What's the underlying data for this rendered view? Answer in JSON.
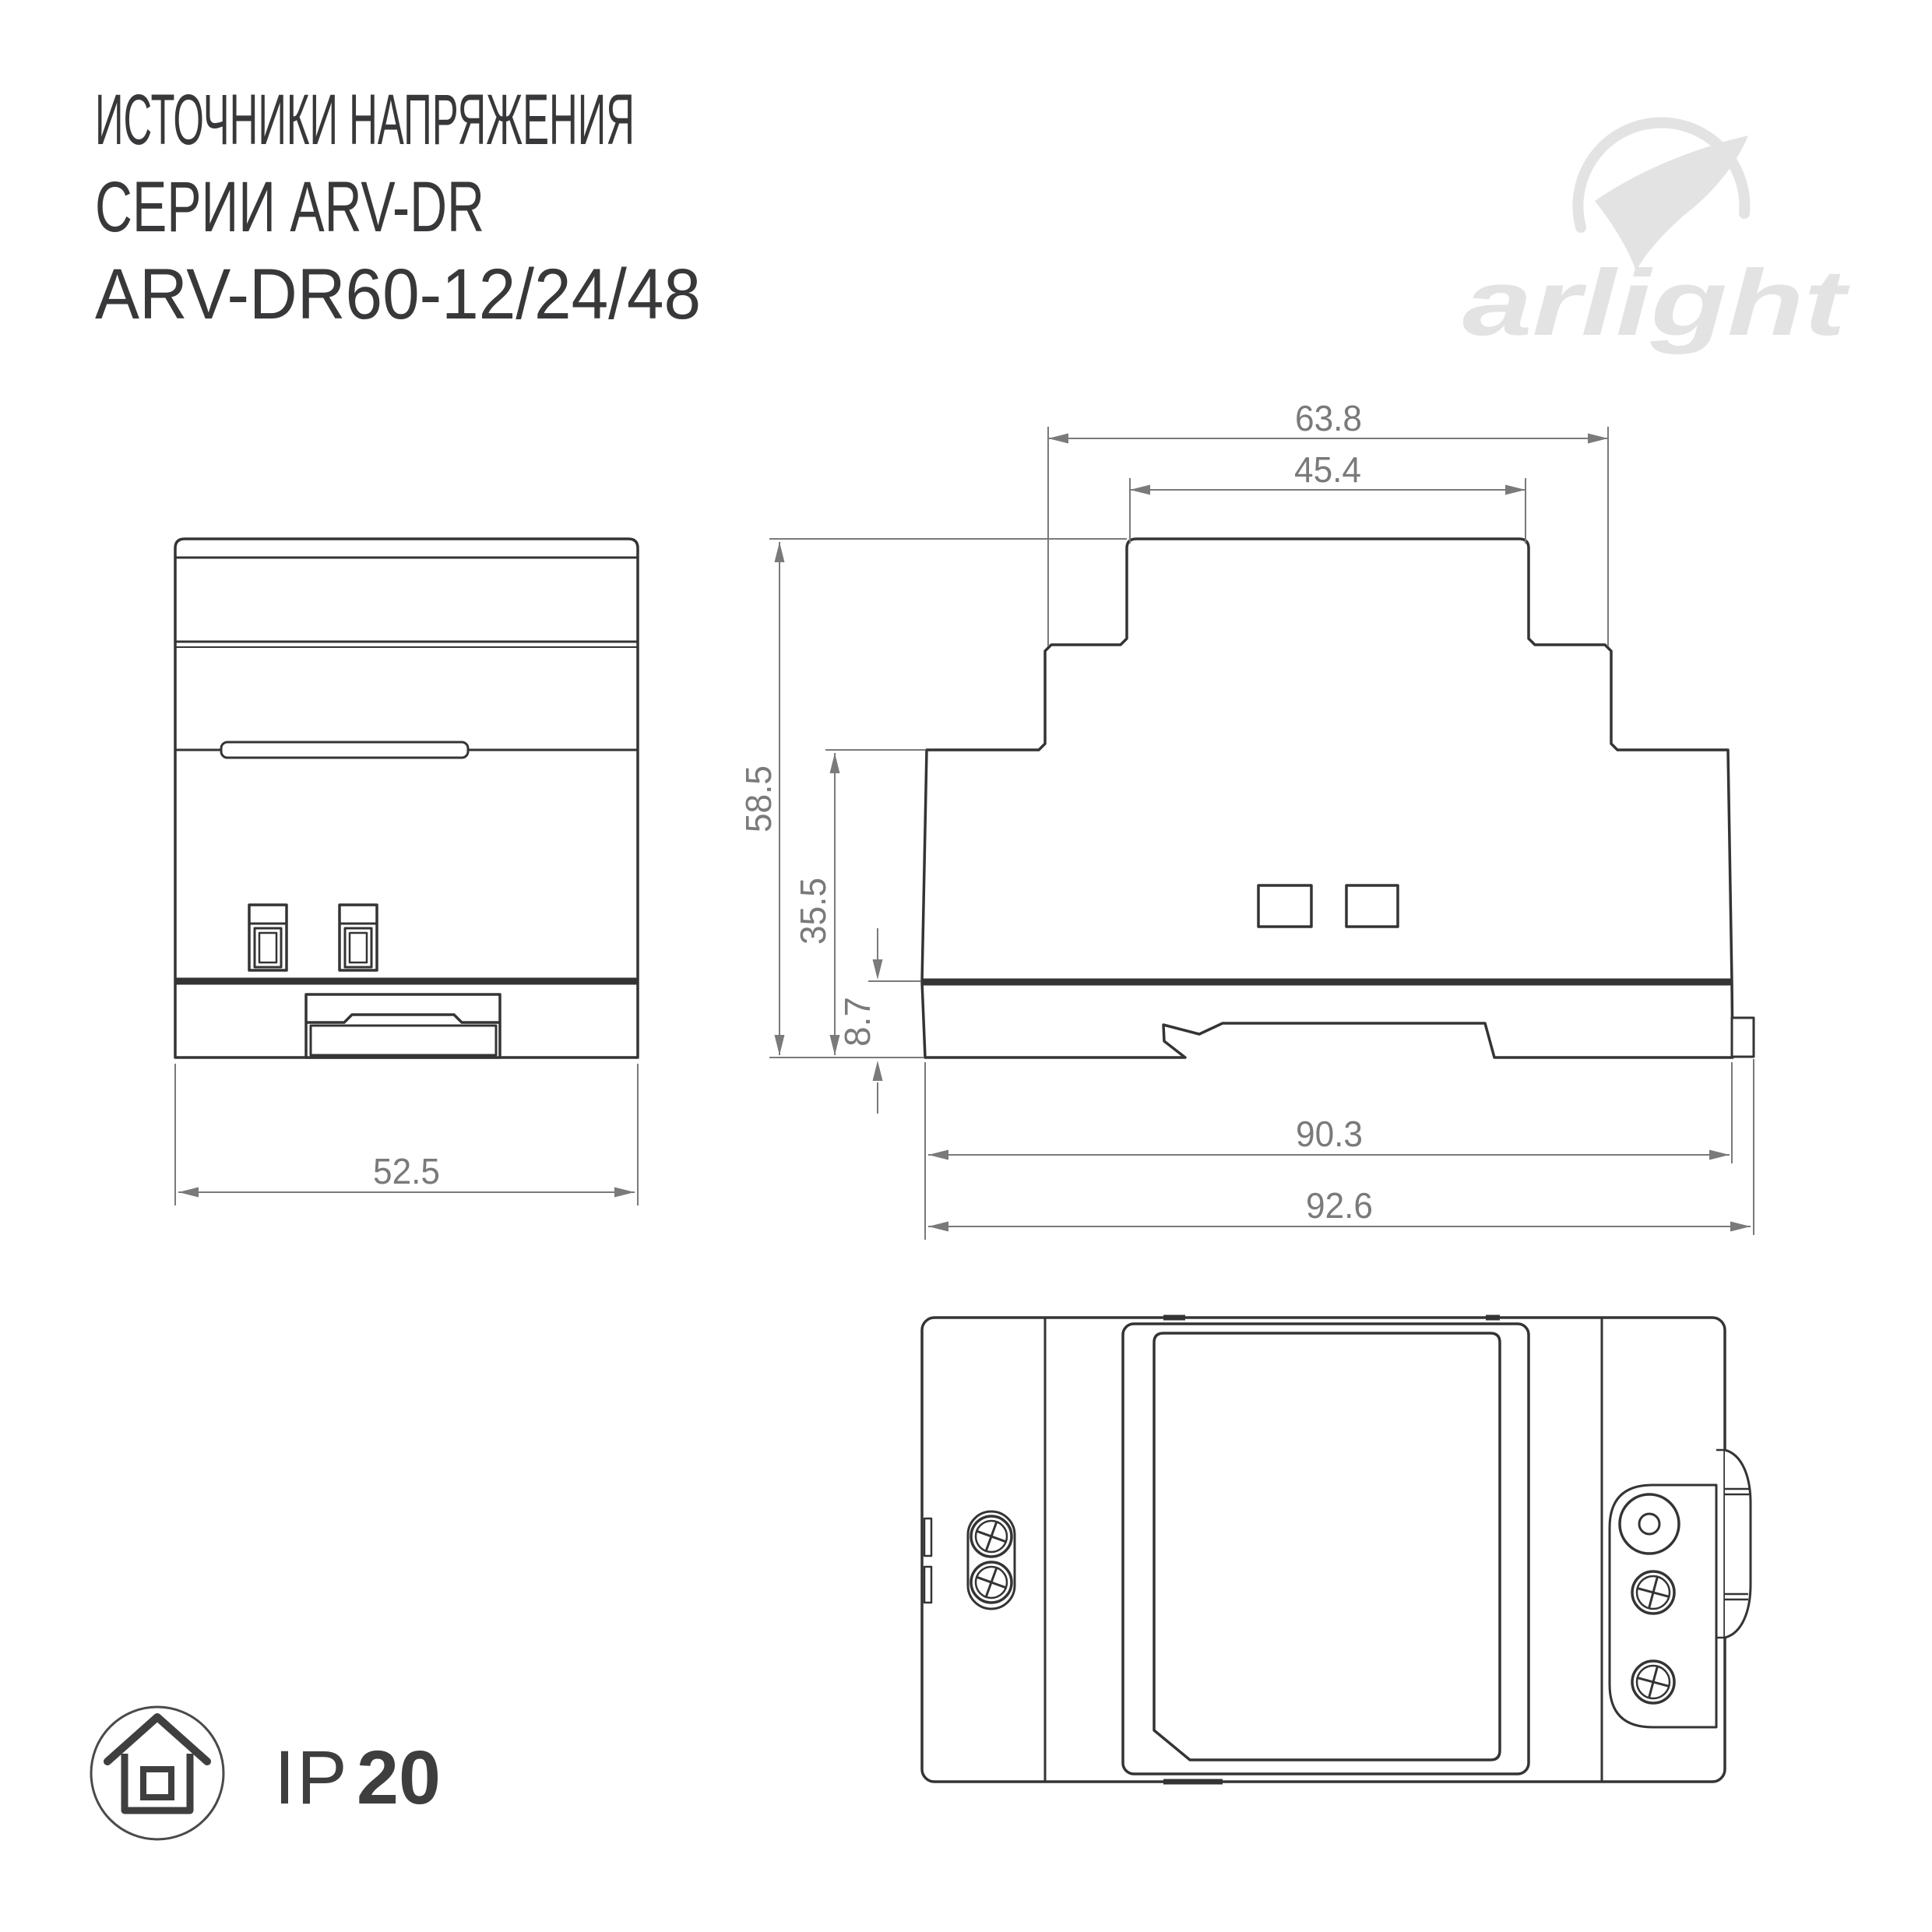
{
  "title": {
    "line1": "ИСТОЧНИКИ НАПРЯЖЕНИЯ",
    "line2": "СЕРИИ ARV-DR",
    "line3": "ARV-DR60-12/24/48"
  },
  "logo": {
    "text": "arlight",
    "icon": "arlight-swoosh-icon",
    "color": "#e3e3e3"
  },
  "drawing": {
    "stroke_color": "#343434",
    "dim_color": "#7a7a7a",
    "views": {
      "front": "front-view",
      "side": "side-view",
      "top": "top-view"
    },
    "dims": {
      "front_width": "52.5",
      "top_outer": "63.8",
      "top_inner": "45.4",
      "height_total": "58.5",
      "height_lower": "35.5",
      "height_rail": "8.7",
      "body_width": "90.3",
      "full_width": "92.6"
    }
  },
  "ip_badge": {
    "icon": "house-indoor-icon",
    "prefix": "IP",
    "value": "20"
  }
}
